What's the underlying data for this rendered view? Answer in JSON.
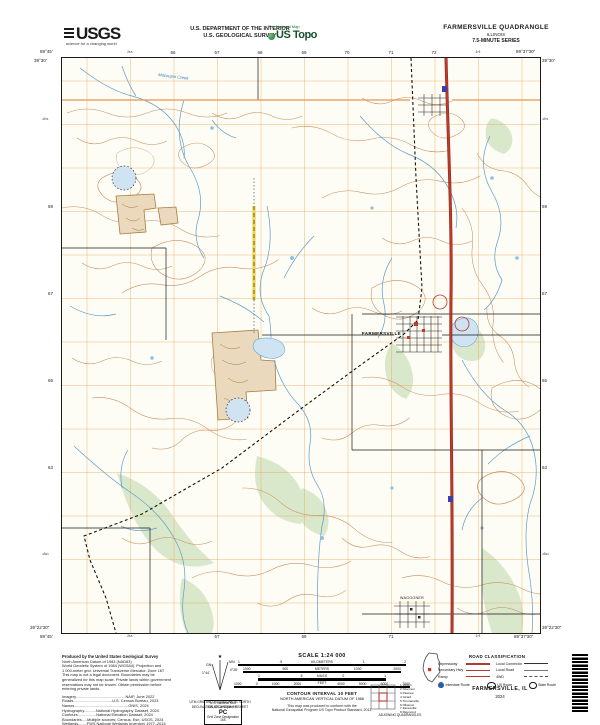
{
  "header": {
    "usgs_logo": "USGS",
    "usgs_tagline": "science for a changing world",
    "dept_line1": "U.S. DEPARTMENT OF THE INTERIOR",
    "dept_line2": "U.S. GEOLOGICAL SURVEY",
    "tnm": "The National Map",
    "ustopo": "US Topo",
    "quad_title": "FARMERSVILLE QUADRANGLE",
    "quad_state": "ILLINOIS",
    "quad_series": "7.5-MINUTE SERIES"
  },
  "map": {
    "corners": {
      "tl_lon": "89°45'",
      "tl_lat": "39°30'",
      "tr_lon": "89°37'30\"",
      "tr_lat": "39°30'",
      "bl_lon": "89°45'",
      "bl_lat": "39°22'30\"",
      "br_lon": "89°37'30\"",
      "br_lat": "39°22'30\""
    },
    "top_eastings": [
      "²⁶⁵",
      "66",
      "67",
      "68",
      "69",
      "70",
      "71",
      "72",
      "²⁷³"
    ],
    "left_northings": [
      "⁴³⁷¹",
      "69",
      "67",
      "65",
      "63",
      "⁴³⁶¹"
    ],
    "labels": {
      "town": "FARMERSVILLE",
      "town_south": "WAGGONER",
      "creek": "Macoupin Creek"
    }
  },
  "footer": {
    "credits": [
      "Produced by the United States Geological Survey",
      "North American Datum of 1983 (NAD83)",
      "World Geodetic System of 1984 (WGS84). Projection and",
      "1 000-meter grid: Universal Transverse Mercator, Zone 16T",
      "This map is not a legal document. Boundaries may be",
      "generalized for this map scale. Private lands within government",
      "reservations may not be shown. Obtain permission before",
      "entering private lands.",
      "Imagery..............................................NAIP, June 2022",
      "Roads....................................U.S. Census Bureau, 2023",
      "Names..................................................GNIS, 2024",
      "Hydrography...........National Hydrography Dataset, 2024",
      "Contours.................National Elevation Dataset, 2024",
      "Boundaries.....Multiple sources; Census, Esri, USGS, 2024",
      "Wetlands........FWS National Wetlands Inventory 1977–2014"
    ],
    "scale_title": "SCALE 1:24 000",
    "bars": [
      {
        "unit": "KILOMETERS",
        "ticks": [
          "1",
          ".5",
          "0",
          "1",
          "2"
        ]
      },
      {
        "unit": "METERS",
        "ticks": [
          "1000",
          "500",
          "0",
          "1000",
          "2000"
        ]
      },
      {
        "unit": "MILES",
        "ticks": [
          "1",
          ".5",
          "0",
          "1"
        ]
      },
      {
        "unit": "FEET",
        "ticks": [
          "1000",
          "0",
          "1000",
          "2000",
          "3000",
          "4000",
          "5000",
          "6000",
          "7000"
        ]
      }
    ],
    "contour": "CONTOUR INTERVAL 10 FEET",
    "datum": "NORTH AMERICAN VERTICAL DATUM OF 1988",
    "conform1": "This map was produced to conform with the",
    "conform2": "National Geospatial Program US Topo Product Standard, 2011.",
    "declination": {
      "gn": "GN",
      "mn": "MN",
      "gn_val": "1°44'",
      "mn_val": "0°28'",
      "caption1": "UTM GRID AND 2024 MAGNETIC NORTH",
      "caption2": "DECLINATION AT CENTER OF SHEET"
    },
    "usng": {
      "title": "U.S. National Grid",
      "l1": "100,000-m Square ID",
      "square": "PC",
      "l2": "Grid Zone Designation",
      "zone": "16S"
    },
    "adjoining": {
      "title": "ADJOINING QUADRANGLES",
      "names": [
        "1 Virden",
        "2 Divernon",
        "3 Pawnee",
        "4 Girard",
        "5 Thomasville",
        "6 Nilwood",
        "7 Zanesville",
        "8 Raymond"
      ]
    },
    "roadclass": {
      "title": "ROAD CLASSIFICATION",
      "rows": [
        {
          "l": "Expressway",
          "r": "Local Connector"
        },
        {
          "l": "Secondary Hwy",
          "r": "Local Road"
        },
        {
          "l": "Ramp",
          "r": "4WD"
        }
      ],
      "routes": [
        "Interstate Route",
        "US Route",
        "State Route"
      ]
    },
    "map_name": "FARMERSVILLE, IL",
    "year": "2024"
  }
}
